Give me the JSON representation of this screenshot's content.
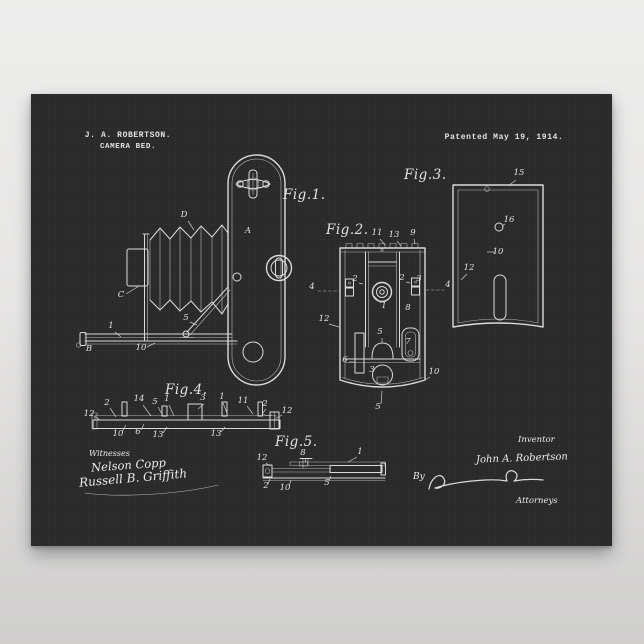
{
  "poster": {
    "header": {
      "name_line": "J. A. ROBERTSON.",
      "title_line": "CAMERA BED.",
      "patent_date": "Patented May 19, 1914."
    },
    "figure_labels": {
      "fig1": "Fig.1.",
      "fig2": "Fig.2.",
      "fig3": "Fig.3.",
      "fig4": "Fig.4.",
      "fig5": "Fig.5."
    },
    "signature_block": {
      "witnesses_label": "Witnesses",
      "witness_1": "Nelson Copp",
      "witness_2": "Russell B. Griffith",
      "inventor_label": "Inventor",
      "inventor_name": "John A. Robertson",
      "by_label": "By",
      "attorneys_label": "Attorneys"
    },
    "colors": {
      "poster_bg": "#2b2b2c",
      "ink": "#dcdbd8",
      "backdrop_top": "#ededec",
      "backdrop_bottom": "#cfcecd"
    },
    "ref_labels": [
      {
        "fig": "fig1",
        "t": "D",
        "x": 153,
        "y": 123,
        "l": [
          157,
          127,
          163,
          136
        ]
      },
      {
        "fig": "fig1",
        "t": "A",
        "x": 217,
        "y": 139
      },
      {
        "fig": "fig1",
        "t": "C",
        "x": 90,
        "y": 203,
        "l": [
          95,
          200,
          108,
          192
        ]
      },
      {
        "fig": "fig1",
        "t": "B",
        "x": 58,
        "y": 257
      },
      {
        "fig": "fig1",
        "t": "1",
        "x": 80,
        "y": 234,
        "l": [
          84,
          238,
          90,
          243
        ]
      },
      {
        "fig": "fig1",
        "t": "10",
        "x": 110,
        "y": 256,
        "l": [
          116,
          253,
          124,
          249
        ]
      },
      {
        "fig": "fig1",
        "t": "5",
        "x": 155,
        "y": 226,
        "l": [
          159,
          228,
          166,
          231
        ]
      },
      {
        "fig": "fig2",
        "t": "11",
        "x": 346,
        "y": 141,
        "l": [
          349,
          145,
          354,
          151
        ]
      },
      {
        "fig": "fig2",
        "t": "13",
        "x": 363,
        "y": 143,
        "l": [
          366,
          147,
          370,
          152
        ]
      },
      {
        "fig": "fig2",
        "t": "9",
        "x": 382,
        "y": 141,
        "l": [
          383,
          145,
          384,
          150
        ]
      },
      {
        "fig": "fig2",
        "t": "4",
        "x": 281,
        "y": 195
      },
      {
        "fig": "fig2",
        "t": "4",
        "x": 417,
        "y": 193
      },
      {
        "fig": "fig2",
        "t": "2",
        "x": 324,
        "y": 187,
        "l": [
          328,
          189,
          332,
          190
        ]
      },
      {
        "fig": "fig2",
        "t": "2",
        "x": 371,
        "y": 186,
        "l": [
          375,
          188,
          379,
          189
        ]
      },
      {
        "fig": "fig2",
        "t": "3",
        "x": 388,
        "y": 187
      },
      {
        "fig": "fig2",
        "t": "12",
        "x": 293,
        "y": 227,
        "l": [
          298,
          230,
          308,
          233
        ]
      },
      {
        "fig": "fig2",
        "t": "1",
        "x": 353,
        "y": 214,
        "l": [
          350,
          209,
          343,
          202
        ]
      },
      {
        "fig": "fig2",
        "t": "8",
        "x": 377,
        "y": 216
      },
      {
        "fig": "fig2",
        "t": "6",
        "x": 314,
        "y": 268,
        "l": [
          318,
          268,
          323,
          268
        ]
      },
      {
        "fig": "fig2",
        "t": "7",
        "x": 377,
        "y": 250
      },
      {
        "fig": "fig2",
        "t": "10",
        "x": 403,
        "y": 280,
        "l": [
          399,
          283,
          392,
          287
        ]
      },
      {
        "fig": "fig2",
        "t": "5",
        "x": 349,
        "y": 240,
        "l": [
          351,
          244,
          351,
          249
        ]
      },
      {
        "fig": "fig2",
        "t": "3",
        "x": 341,
        "y": 278
      },
      {
        "fig": "fig2",
        "t": "5",
        "x": 347,
        "y": 315,
        "l": [
          350,
          310,
          351,
          297
        ]
      },
      {
        "fig": "fig3",
        "t": "15",
        "x": 488,
        "y": 81,
        "l": [
          485,
          86,
          477,
          92
        ]
      },
      {
        "fig": "fig3",
        "t": "16",
        "x": 478,
        "y": 128,
        "l": [
          474,
          130,
          471,
          132
        ]
      },
      {
        "fig": "fig3",
        "t": "10",
        "x": 467,
        "y": 160
      },
      {
        "fig": "fig3",
        "t": "12",
        "x": 438,
        "y": 176,
        "l": [
          436,
          180,
          430,
          186
        ]
      },
      {
        "fig": "fig4",
        "t": "12",
        "x": 58,
        "y": 322,
        "l": [
          63,
          322,
          69,
          326
        ]
      },
      {
        "fig": "fig4",
        "t": "2",
        "x": 76,
        "y": 311,
        "l": [
          79,
          314,
          85,
          323
        ]
      },
      {
        "fig": "fig4",
        "t": "14",
        "x": 108,
        "y": 307,
        "l": [
          112,
          311,
          120,
          322
        ]
      },
      {
        "fig": "fig4",
        "t": "5",
        "x": 124,
        "y": 310,
        "l": [
          127,
          313,
          132,
          322
        ]
      },
      {
        "fig": "fig4",
        "t": "1",
        "x": 136,
        "y": 307,
        "l": [
          138,
          311,
          143,
          322
        ]
      },
      {
        "fig": "fig4",
        "t": "3",
        "x": 172,
        "y": 306,
        "l": [
          173,
          310,
          167,
          315
        ]
      },
      {
        "fig": "fig4",
        "t": "1",
        "x": 191,
        "y": 305,
        "l": [
          192,
          309,
          196,
          319
        ]
      },
      {
        "fig": "fig4",
        "t": "11",
        "x": 212,
        "y": 309,
        "l": [
          216,
          312,
          222,
          320
        ]
      },
      {
        "fig": "fig4",
        "t": "2",
        "x": 234,
        "y": 312,
        "l": [
          235,
          315,
          231,
          320
        ]
      },
      {
        "fig": "fig4",
        "t": "12",
        "x": 256,
        "y": 319,
        "l": [
          251,
          321,
          246,
          324
        ]
      },
      {
        "fig": "fig4",
        "t": "10",
        "x": 87,
        "y": 342,
        "l": [
          91,
          338,
          95,
          331
        ]
      },
      {
        "fig": "fig4",
        "t": "6",
        "x": 107,
        "y": 340,
        "l": [
          110,
          336,
          113,
          330
        ]
      },
      {
        "fig": "fig4",
        "t": "13",
        "x": 127,
        "y": 343,
        "l": [
          132,
          339,
          136,
          333
        ]
      },
      {
        "fig": "fig4",
        "t": "13",
        "x": 185,
        "y": 342,
        "l": [
          190,
          338,
          194,
          333
        ]
      },
      {
        "fig": "fig5",
        "t": "12",
        "x": 231,
        "y": 366,
        "l": [
          235,
          369,
          239,
          372
        ]
      },
      {
        "fig": "fig5",
        "t": "8",
        "x": 272,
        "y": 361,
        "l": [
          274,
          364,
          275,
          368
        ]
      },
      {
        "fig": "fig5",
        "t": "1",
        "x": 329,
        "y": 360,
        "l": [
          326,
          363,
          317,
          368
        ]
      },
      {
        "fig": "fig5",
        "t": "2",
        "x": 235,
        "y": 394,
        "l": [
          237,
          390,
          239,
          385
        ]
      },
      {
        "fig": "fig5",
        "t": "10",
        "x": 254,
        "y": 396,
        "l": [
          258,
          392,
          260,
          386
        ]
      },
      {
        "fig": "fig5",
        "t": "5",
        "x": 296,
        "y": 391,
        "l": [
          298,
          387,
          300,
          382
        ]
      }
    ]
  }
}
